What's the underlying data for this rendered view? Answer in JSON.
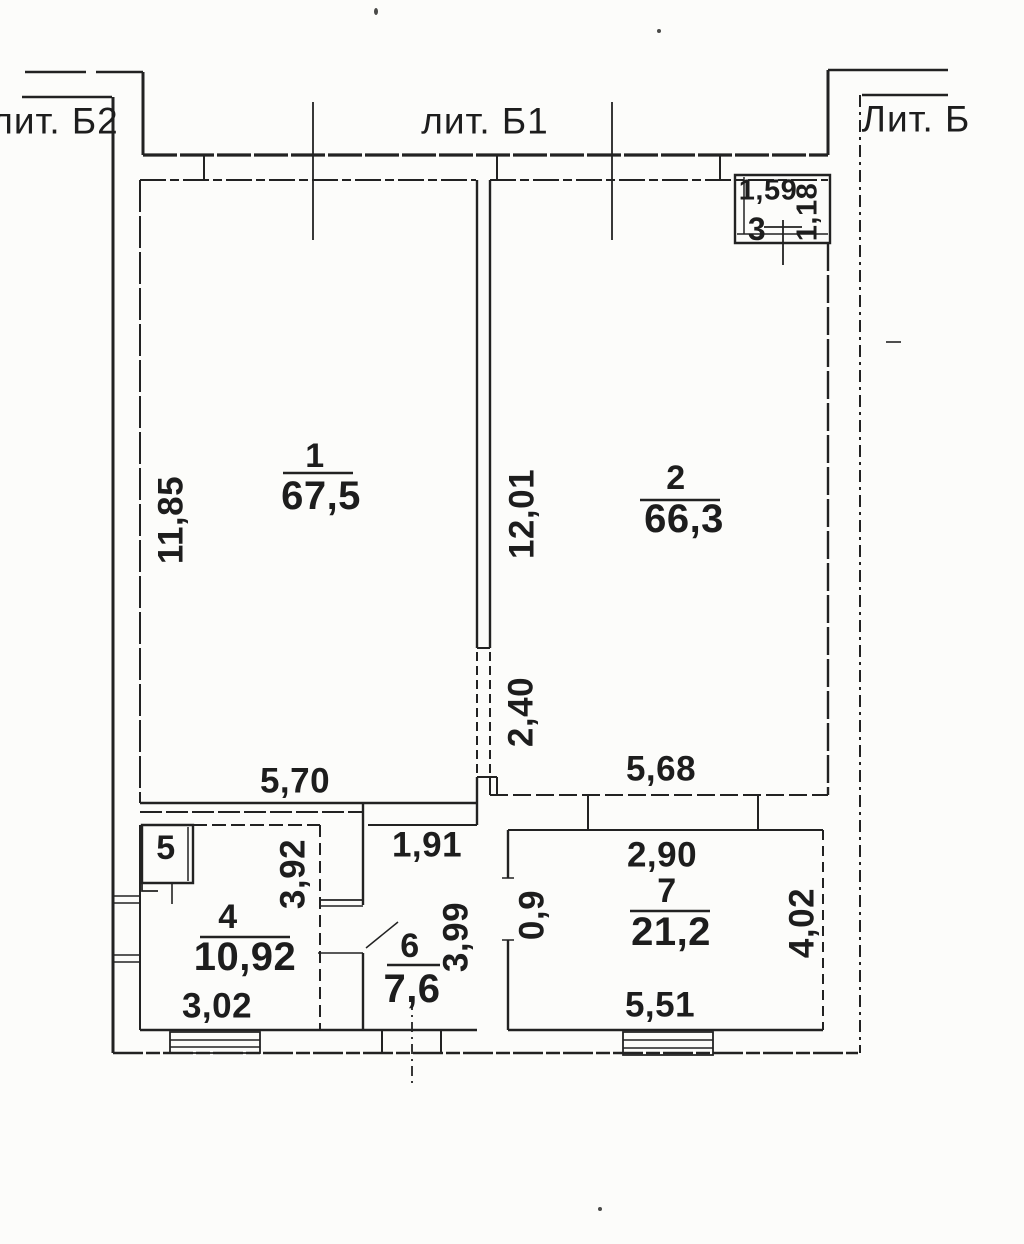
{
  "buildings": {
    "lit_b2": "лит. Б2",
    "lit_b1": "лит. Б1",
    "lit_b": "Лит. Б"
  },
  "rooms": {
    "r1": {
      "number": "1",
      "area": "67,5"
    },
    "r2": {
      "number": "2",
      "area": "66,3"
    },
    "r3": {
      "number": "3"
    },
    "r4": {
      "number": "4",
      "area": "10,92"
    },
    "r5": {
      "number": "5"
    },
    "r6": {
      "number": "6",
      "area": "7,6"
    },
    "r7": {
      "number": "7",
      "area": "21,2"
    }
  },
  "dimensions": {
    "room1_height": "11,85",
    "room1_width": "5,70",
    "room2_height": "12,01",
    "room2_lower": "2,40",
    "room2_width": "5,68",
    "room3_width": "1,59",
    "room3_height": "1,18",
    "room4_height": "3,92",
    "room4_width": "3,02",
    "room6_width": "1,91",
    "room6_height": "3,99",
    "room7_left": "0,9",
    "room7_top": "2,90",
    "room7_right": "4,02",
    "room7_bottom": "5,51"
  },
  "colors": {
    "ink": "#222222",
    "paper": "#fcfcfa"
  }
}
